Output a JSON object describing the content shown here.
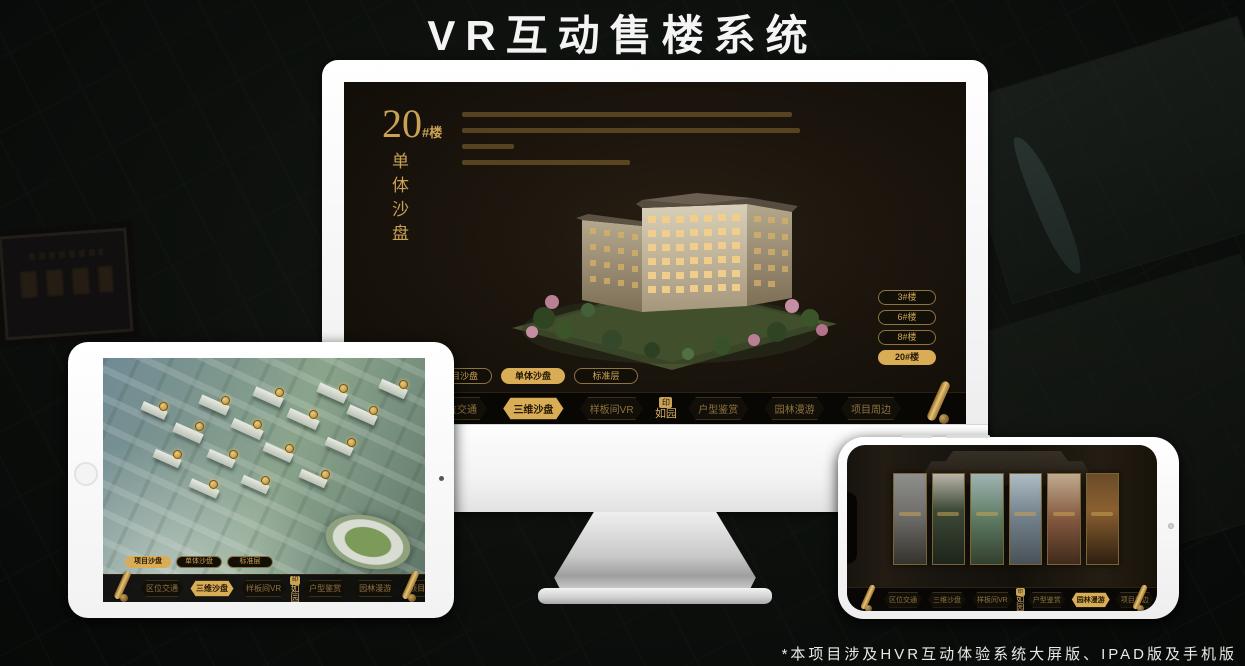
{
  "page": {
    "title": "VR互动售楼系统",
    "footnote": "*本项目涉及HVR互动体验系统大屏版、IPAD版及手机版"
  },
  "colors": {
    "gold": "#c9a254",
    "gold_active_bg": "#d9ac56",
    "screen_bg": "#1b150d",
    "navbar_bg": "#080604"
  },
  "monitor_app": {
    "heading": {
      "number": "20",
      "suffix": "#楼",
      "vertical_subtitle": "单体沙盘"
    },
    "floor_buttons": [
      {
        "label": "3#楼",
        "active": false
      },
      {
        "label": "6#楼",
        "active": false
      },
      {
        "label": "8#楼",
        "active": false
      },
      {
        "label": "20#楼",
        "active": true
      }
    ],
    "tabs": [
      {
        "label": "项目沙盘",
        "active": false
      },
      {
        "label": "单体沙盘",
        "active": true
      },
      {
        "label": "标准层",
        "active": false
      }
    ]
  },
  "nav": {
    "logo": "如园",
    "seal_glyph": "印",
    "items": [
      {
        "label": "区位交通"
      },
      {
        "label": "三维沙盘"
      },
      {
        "label": "样板间VR"
      },
      {
        "label": "户型鉴赏"
      },
      {
        "label": "园林漫游"
      },
      {
        "label": "项目周边"
      }
    ],
    "monitor_active": "三维沙盘",
    "tablet_active": "三维沙盘",
    "phone_active": "园林漫游"
  },
  "tablet_app": {
    "tabs": [
      {
        "label": "项目沙盘",
        "active": true
      },
      {
        "label": "单体沙盘",
        "active": false
      },
      {
        "label": "标准层",
        "active": false
      }
    ]
  }
}
